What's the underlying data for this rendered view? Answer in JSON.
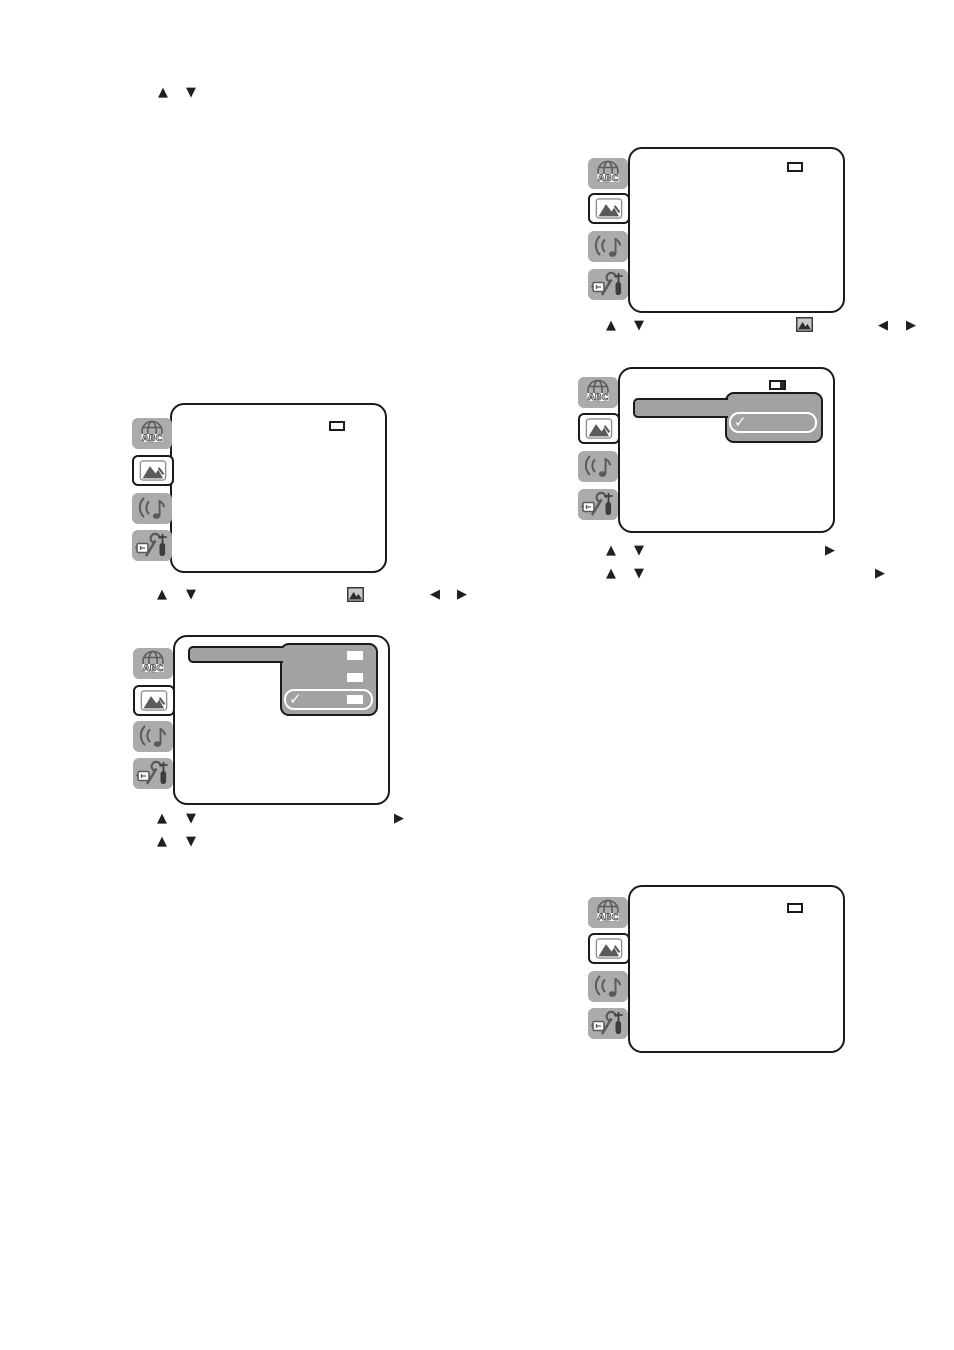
{
  "glyphs": {
    "up": "▲",
    "down": "▼",
    "left": "◀",
    "right": "▶",
    "check": "✓"
  },
  "colors": {
    "page_background": "#ffffff",
    "tab_gray": "#ababab",
    "icon_gray": "#5a5a5a",
    "highlight_gray": "#a2a2a2",
    "outline_dark": "#1b1b1b",
    "check_white": "#ffffff"
  },
  "icons": {
    "tab_icons": [
      {
        "name": "language-icon",
        "depicts": "globe with letters",
        "text_in_artwork": "ABC"
      },
      {
        "name": "picture-icon",
        "depicts": "framed mountains"
      },
      {
        "name": "sound-icon",
        "depicts": "music note with sound waves"
      },
      {
        "name": "setup-icon",
        "depicts": "wrench, screwdriver and connector tools"
      }
    ],
    "hint_icon": {
      "name": "picture-menu-icon",
      "depicts": "small framed picture"
    }
  },
  "figures": [
    {
      "id": "top-right-menu",
      "selected_tab": "picture",
      "indicator_box": "empty",
      "controls_below": [
        "up",
        "down",
        "picture-menu-icon",
        "left",
        "right"
      ]
    },
    {
      "id": "right-middle-menu",
      "selected_tab": "picture",
      "indicator_box": "partially-filled",
      "highlighted_row": true,
      "submenu": {
        "options": [
          {
            "checked": true,
            "value_box": false
          }
        ]
      },
      "controls_below": [
        [
          "up",
          "down",
          "right"
        ],
        [
          "up",
          "down",
          "right"
        ]
      ]
    },
    {
      "id": "left-top-menu",
      "selected_tab": "picture",
      "indicator_box": "empty",
      "controls_below": [
        "up",
        "down",
        "picture-menu-icon",
        "left",
        "right"
      ]
    },
    {
      "id": "left-middle-menu",
      "selected_tab": "picture",
      "highlighted_row": true,
      "submenu": {
        "options": [
          {
            "checked": false,
            "value_box": true
          },
          {
            "checked": false,
            "value_box": true
          },
          {
            "checked": true,
            "value_box": true
          }
        ]
      },
      "controls_below": [
        [
          "up",
          "down",
          "right"
        ],
        [
          "up",
          "down"
        ]
      ]
    },
    {
      "id": "bottom-right-menu",
      "selected_tab": "picture",
      "indicator_box": "empty",
      "controls_below": []
    }
  ],
  "standalone_controls": {
    "top_left": [
      "up",
      "down"
    ]
  }
}
